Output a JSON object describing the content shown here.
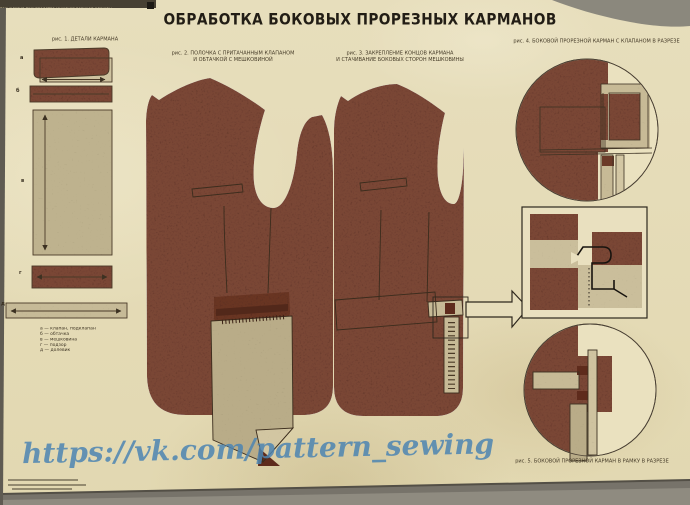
{
  "poster": {
    "top_strip_text": "технология производства мужской верхней одежды",
    "title": "ОБРАБОТКА БОКОВЫХ ПРОРЕЗНЫХ КАРМАНОВ",
    "watermark": "https://vk.com/pattern_sewing",
    "figures": {
      "fig1": {
        "caption": "рис. 1. ДЕТАЛИ КАРМАНА",
        "part_labels": [
          "а",
          "б",
          "в",
          "г",
          "д"
        ],
        "legend": [
          "а — клапан, подклапан",
          "б — обтачка",
          "в — мешковина",
          "г — подзор",
          "д — долевик"
        ]
      },
      "fig2": {
        "caption_line1": "рис. 2. ПОЛОЧКА С ПРИТАЧАННЫМ КЛАПАНОМ",
        "caption_line2": "И ОБТАЧКОЙ С МЕШКОВИНОЙ"
      },
      "fig3": {
        "caption_line1": "рис. 3. ЗАКРЕПЛЕНИЕ КОНЦОВ КАРМАНА",
        "caption_line2": "И СТАЧИВАНИЕ БОКОВЫХ СТОРОН МЕШКОВИНЫ"
      },
      "fig4": {
        "caption": "рис. 4. БОКОВОЙ ПРОРЕЗНОЙ КАРМАН С КЛАПАНОМ В РАЗРЕЗЕ"
      },
      "fig5": {
        "caption": "рис. 5. БОКОВОЙ ПРОРЕЗНОЙ КАРМАН В РАМКУ В РАЗРЕЗЕ"
      }
    },
    "colors": {
      "paper": "#e6ddba",
      "fabric_brown": "#7a4635",
      "flap_dark": "#693524",
      "bag_tan": "#b9ac88",
      "detail_tan": "#c7ba96",
      "line": "#3c3122",
      "maroon": "#5e2b1c",
      "watermark_blue": "#4d85b2",
      "backdrop_gray": "#8b887d"
    }
  }
}
